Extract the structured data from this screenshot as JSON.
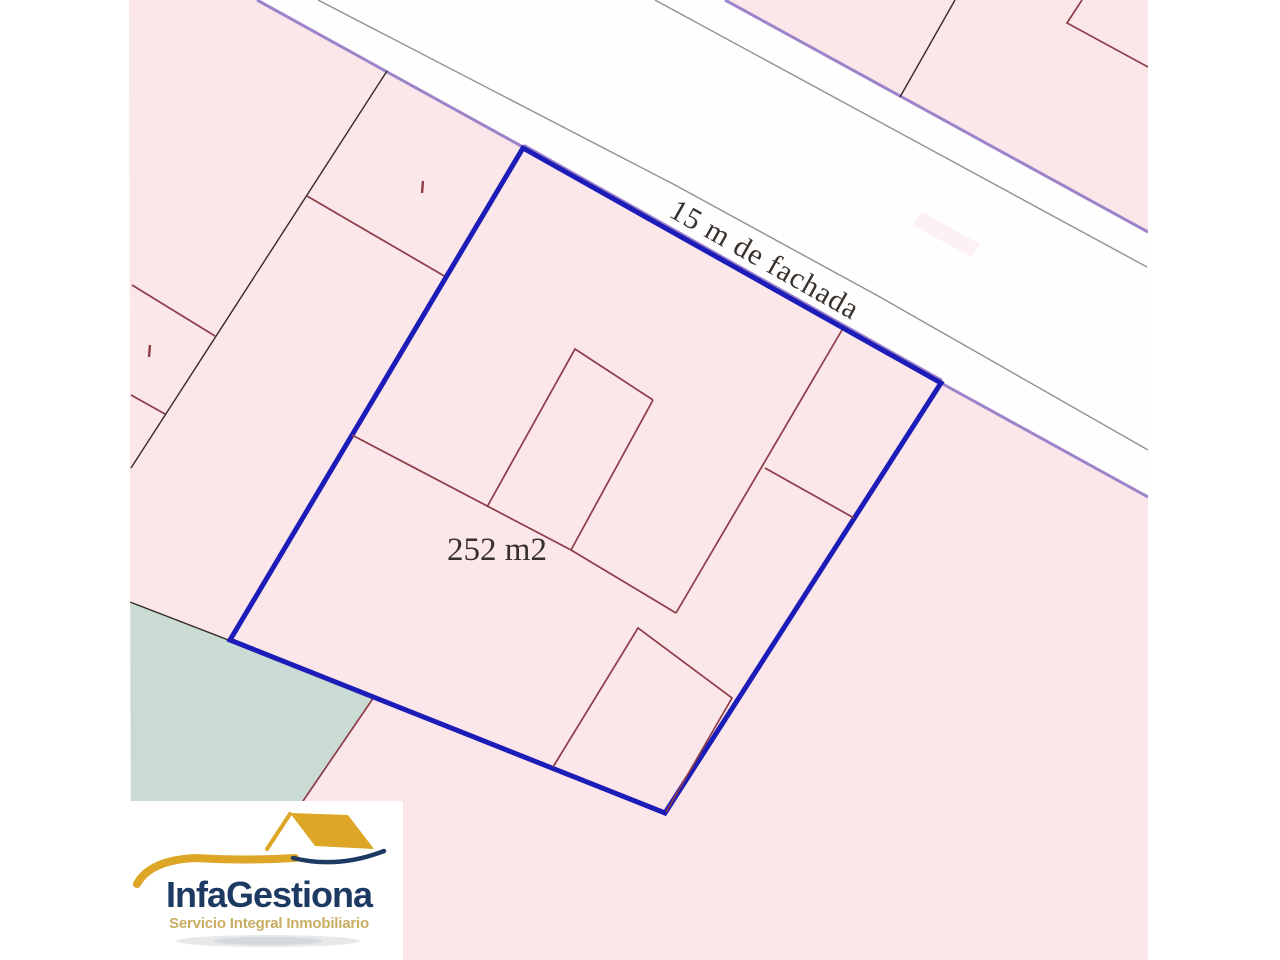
{
  "map": {
    "labels": {
      "frontage": "15 m de fachada",
      "area": "252 m2"
    }
  },
  "logo": {
    "title": "InfaGestiona",
    "tagline": "Servicio Integral Inmobiliario",
    "icon": "house-roof-swoosh-icon"
  },
  "theme": {
    "page-bg": "#ffffff",
    "parcel-fill": "#fbe6e9",
    "road-fill": "#fefefe",
    "green-fill": "#c9dbd2",
    "highlight-blue": "#1c1cb8",
    "block-purple": "#9d83c9",
    "curb-gray": "#909095",
    "boundary-black": "#332b26",
    "building-red": "#8e3c46",
    "label-ink": "#38302b",
    "logo-navy": "#1d3a63",
    "logo-gold": "#dda627",
    "logo-tagline": "#c9ad62",
    "logo-box": "#ffffff",
    "logo-shadow": "#8f969e"
  }
}
